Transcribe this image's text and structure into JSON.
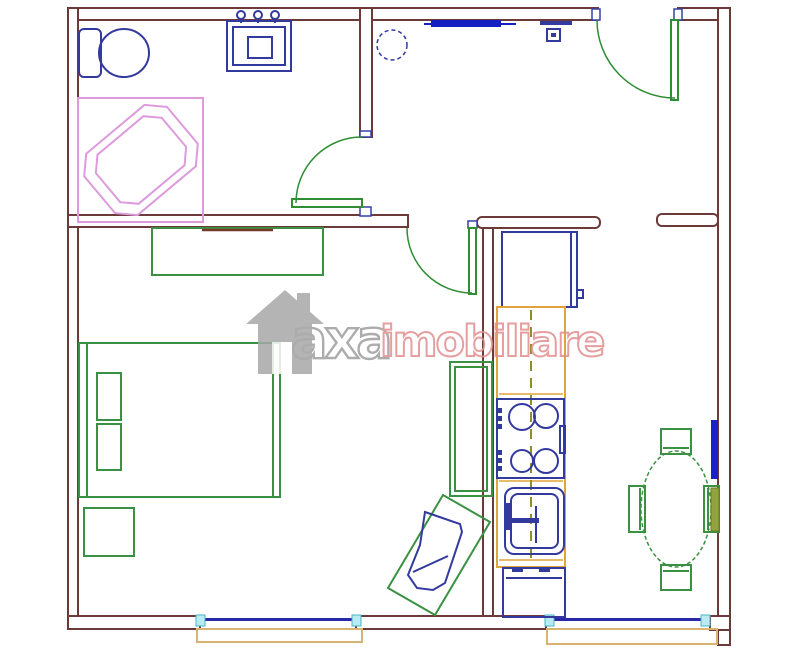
{
  "watermark": {
    "brand": "axa",
    "suffix": "imobiliare",
    "icon": "house-icon"
  },
  "colors": {
    "wall": "#6d3a3a",
    "furniture_green": "#3a9142",
    "door_green": "#2f8d33",
    "fixture_navy": "#333a9e",
    "accent_blue": "#1420c0",
    "tub_pink": "#dd9add",
    "counter_orange": "#e0a43c",
    "dash_olive": "#8f8f2a",
    "window_glass": "#2828a8",
    "window_marker_cyan": "#b8ecf2",
    "sill_tan": "#d8b470",
    "watermark_gray": "#9e9e9e",
    "watermark_pink": "#e28f8f",
    "background": "#ffffff"
  },
  "plan": {
    "type": "apartment-floor-plan",
    "rooms": [
      {
        "name": "bathroom",
        "fixtures": [
          "toilet",
          "vanity-sink",
          "corner-bathtub",
          "bathroom-door"
        ]
      },
      {
        "name": "hallway",
        "fixtures": [
          "ceiling-fixture",
          "wall-shelf",
          "intercom-unit",
          "entrance-door"
        ]
      },
      {
        "name": "bedroom-living",
        "fixtures": [
          "dresser",
          "double-bed",
          "pillows",
          "nightstand",
          "bookcase",
          "armchair",
          "bedroom-door",
          "window"
        ]
      },
      {
        "name": "kitchen",
        "fixtures": [
          "fridge",
          "counter",
          "stove",
          "sink",
          "washing-machine",
          "window"
        ]
      },
      {
        "name": "dining",
        "fixtures": [
          "oval-table",
          "four-chairs",
          "radiator",
          "heater"
        ]
      }
    ]
  }
}
